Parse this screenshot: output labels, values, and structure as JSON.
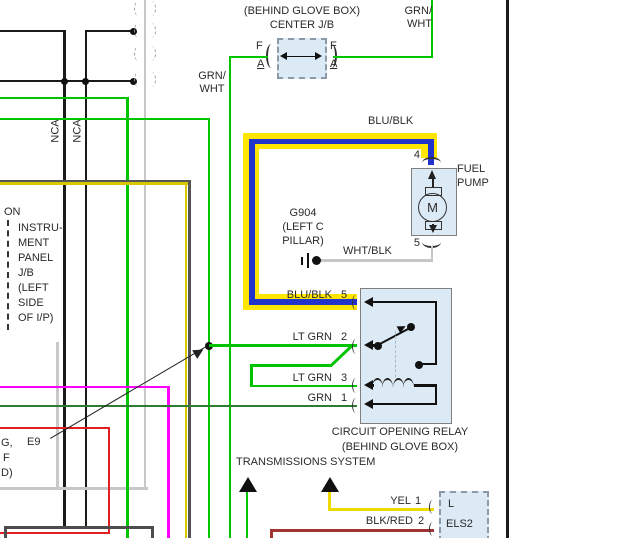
{
  "colors": {
    "green_bright": "#00c400",
    "green_dark": "#2e7d2e",
    "yellow_highlight": "#ffe600",
    "blue": "#2233cc",
    "magenta": "#ff00ff",
    "yellow_wire": "#d8c600",
    "gray_wire": "#c8c8c8",
    "dark_gray_wire": "#555555",
    "red_box": "#e02020",
    "dark_red": "#a23333",
    "component_fill": "#dceaf6",
    "component_border": "#808080"
  },
  "jb_connector": {
    "location": "(BEHIND GLOVE BOX)",
    "name": "CENTER J/B",
    "pin_left_row": "F",
    "pin_left_cavity": "A",
    "pin_right_row": "F",
    "pin_right_cavity": "A"
  },
  "wire_labels": {
    "grn_wht_left": "GRN/\nWHT",
    "grn_wht_right": "GRN/\nWHT",
    "blu_blk_top": "BLU/BLK",
    "wht_blk": "WHT/BLK"
  },
  "fuel_pump": {
    "label": "FUEL\nPUMP",
    "pin_top": "4",
    "pin_bottom": "5",
    "motor_letter": "M"
  },
  "ground": {
    "id": "G904",
    "location": "(LEFT C\nPILLAR)"
  },
  "relay": {
    "caption_line1": "CIRCUIT OPENING RELAY",
    "caption_line2": "(BEHIND GLOVE BOX)",
    "rows": [
      {
        "label": "BLU/BLK",
        "pin": "5"
      },
      {
        "label": "LT GRN",
        "pin": "2"
      },
      {
        "label": "LT GRN",
        "pin": "3"
      },
      {
        "label": "GRN",
        "pin": "1"
      }
    ]
  },
  "left_panel": {
    "nca_left": "NCA",
    "nca_right": "NCA",
    "label_top": "ON",
    "jb_label": "INSTRU-\nMENT\nPANEL\nJ/B\n(LEFT\nSIDE\nOF I/P)"
  },
  "e9": {
    "ref": "E9",
    "fragments": [
      "G,",
      "F",
      "D)"
    ]
  },
  "bottom": {
    "system": "TRANSMISSIONS SYSTEM"
  },
  "els2": {
    "rows": [
      {
        "label": "YEL",
        "pin": "1"
      },
      {
        "label": "BLK/RED",
        "pin": "2"
      }
    ],
    "cavity": "L",
    "name": "ELS2"
  }
}
